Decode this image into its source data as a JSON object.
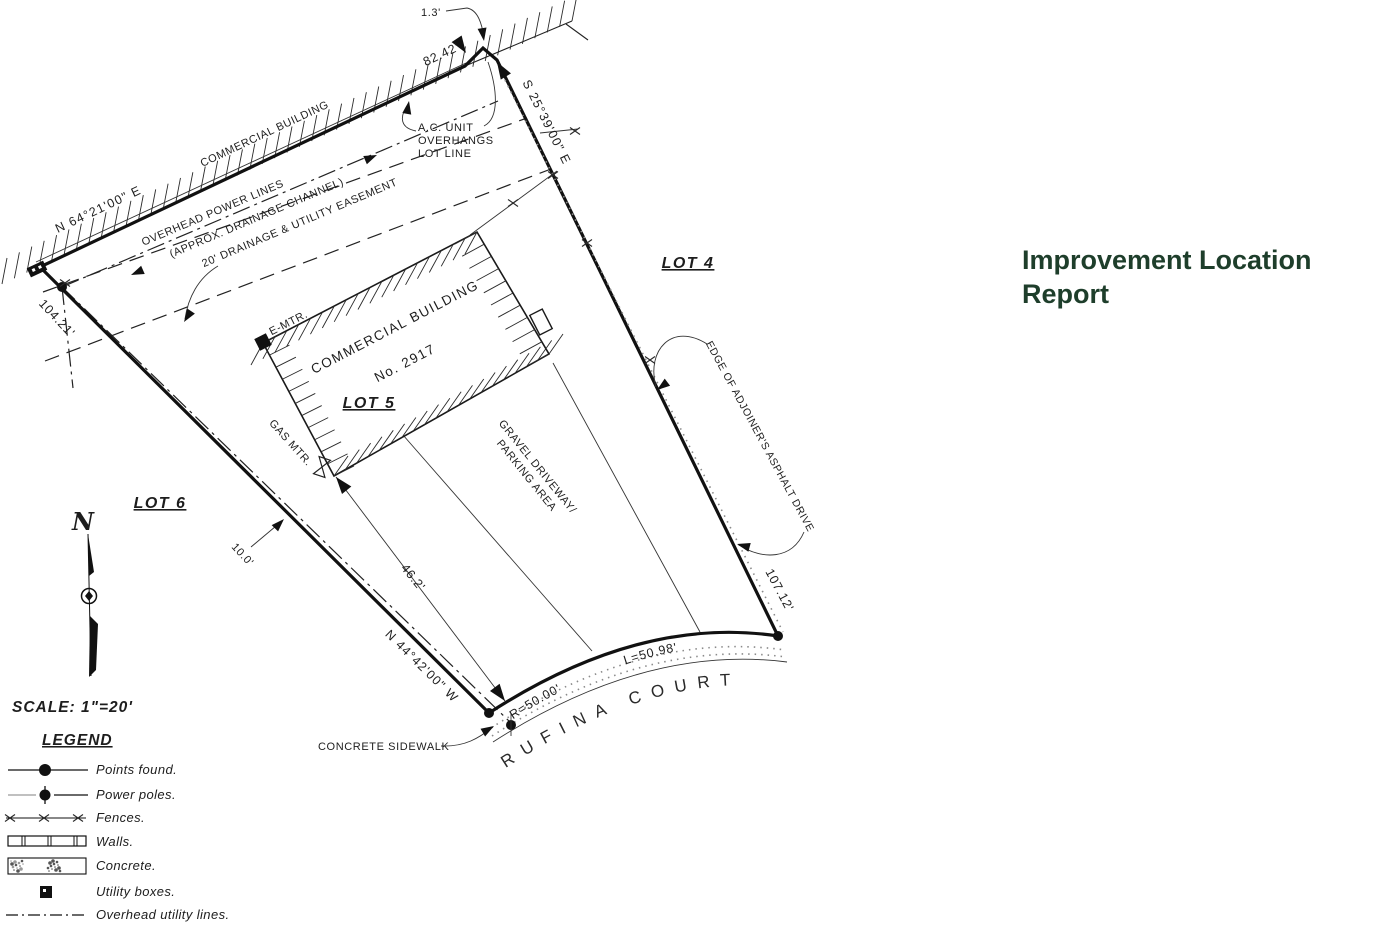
{
  "title": "Improvement Location Report",
  "colors": {
    "title_green": "#1e3e2b",
    "ink": "#1d1d1d"
  },
  "scale_label": "SCALE:  1\"=20'",
  "street": "RUFINA COURT",
  "lots": {
    "l4": "LOT 4",
    "l5": "LOT 5",
    "l6": "LOT 6"
  },
  "bearings": {
    "top": "N 64°21'00\" E",
    "right": "S 25°39'00\" E",
    "bottom": "N 44°42'00\" W"
  },
  "dims": {
    "top": "82.42'",
    "left": "104.21'",
    "right": "107.12'",
    "overhang": "1.3'",
    "drive": "46.2'",
    "offset": "10.0'",
    "curve_r": "R=50.00'",
    "curve_l": "L=50.98'"
  },
  "labels": {
    "adjoiner": "COMMERCIAL BUILDING",
    "power1": "OVERHEAD POWER LINES",
    "power2": "(APPROX. DRAINAGE CHANNEL)",
    "easement": "20' DRAINAGE & UTILITY EASEMENT",
    "ac1": "A.C. UNIT",
    "ac2": "OVERHANGS",
    "ac3": "LOT LINE",
    "bldg1": "COMMERCIAL BUILDING",
    "bldg2": "No. 2917",
    "emtr": "E-MTR.",
    "gas": "GAS MTR.",
    "gravel1": "GRAVEL DRIVEWAY/",
    "gravel2": "PARKING AREA",
    "edge": "EDGE OF ADJOINER'S ASPHALT DRIVE",
    "sidewalk": "CONCRETE SIDEWALK",
    "north": "N"
  },
  "legend": {
    "heading": "LEGEND",
    "items": [
      {
        "icon": "points-found-icon",
        "label": "Points found."
      },
      {
        "icon": "power-pole-icon",
        "label": "Power poles."
      },
      {
        "icon": "fence-icon",
        "label": "Fences."
      },
      {
        "icon": "wall-icon",
        "label": "Walls."
      },
      {
        "icon": "concrete-icon",
        "label": "Concrete."
      },
      {
        "icon": "utility-box-icon",
        "label": "Utility boxes."
      },
      {
        "icon": "overhead-line-icon",
        "label": "Overhead utility lines."
      }
    ]
  }
}
